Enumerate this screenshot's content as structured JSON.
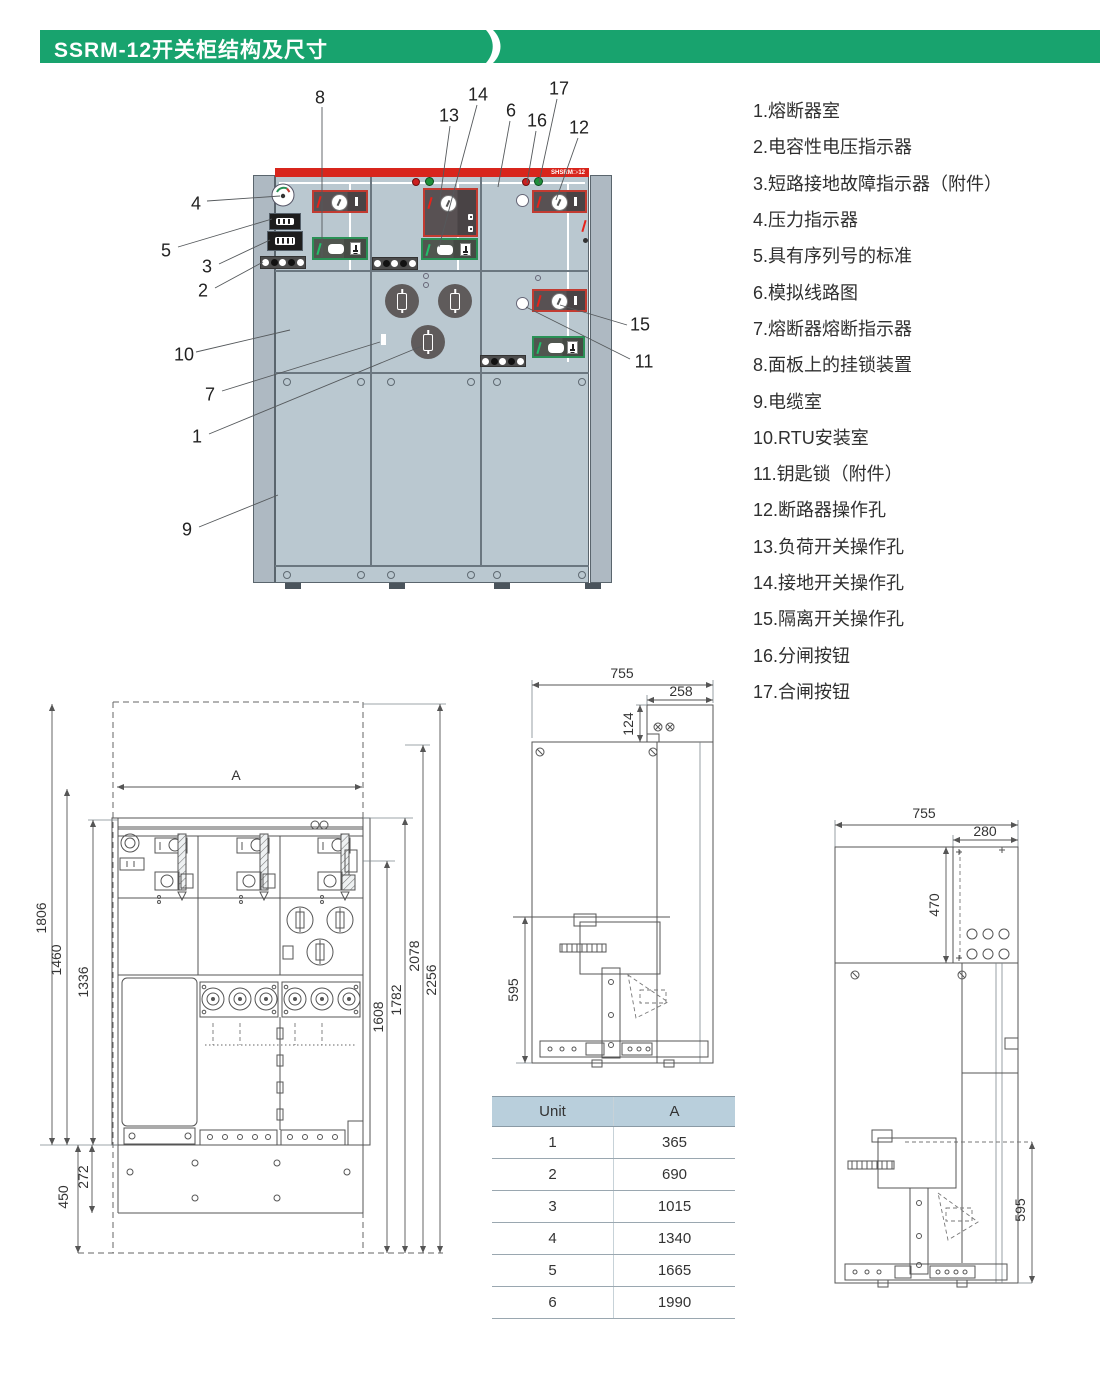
{
  "header": {
    "title": "SSRM-12开关柜结构及尺寸"
  },
  "cabinet": {
    "model_label": "SHSRM□-12",
    "callouts": [
      "8",
      "13",
      "14",
      "6",
      "16",
      "17",
      "12",
      "4",
      "5",
      "3",
      "2",
      "10",
      "7",
      "1",
      "9",
      "15",
      "11"
    ]
  },
  "legend": {
    "items": [
      "1.熔断器室",
      "2.电容性电压指示器",
      "3.短路接地故障指示器（附件）",
      "4.压力指示器",
      "5.具有序列号的标准",
      "6.模拟线路图",
      "7.熔断器熔断指示器",
      "8.面板上的挂锁装置",
      "9.电缆室",
      "10.RTU安装室",
      "11.钥匙锁（附件）",
      "12.断路器操作孔",
      "13.负荷开关操作孔",
      "14.接地开关操作孔",
      "15.隔离开关操作孔",
      "16.分闸按钮",
      "17.合闸按钮"
    ]
  },
  "front_dims": {
    "width_label": "A",
    "left": [
      "1806",
      "1460",
      "1336"
    ],
    "right": [
      "1608",
      "1782",
      "2078",
      "2256"
    ],
    "bottom": [
      "450",
      "272"
    ]
  },
  "side1_dims": {
    "width": "755",
    "box_w": "258",
    "box_h": "124",
    "lower": "595"
  },
  "side2_dims": {
    "width": "755",
    "box_w": "280",
    "box_h": "470",
    "lower": "595"
  },
  "unit_table": {
    "headers": [
      "Unit",
      "A"
    ],
    "rows": [
      [
        "1",
        "365"
      ],
      [
        "2",
        "690"
      ],
      [
        "3",
        "1015"
      ],
      [
        "4",
        "1340"
      ],
      [
        "5",
        "1665"
      ],
      [
        "6",
        "1990"
      ]
    ]
  }
}
